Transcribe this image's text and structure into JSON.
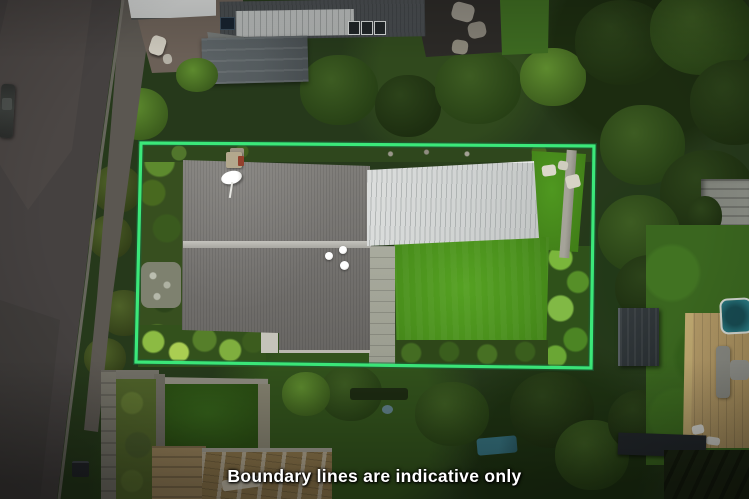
{
  "caption": {
    "text": "Boundary lines are indicative only"
  },
  "overlay": {
    "boundary_color": "#3BE87A",
    "boundary_shadow_color": "#17663A"
  }
}
